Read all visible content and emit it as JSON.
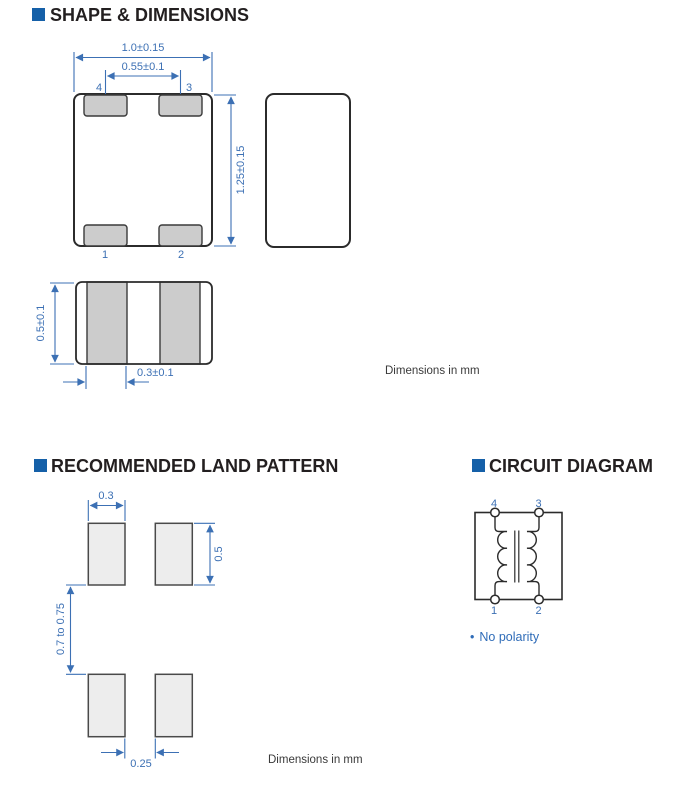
{
  "colors": {
    "accent_blue": "#1560a8",
    "dimension_blue": "#3c70b4",
    "ink": "#231f20",
    "pad_gray": "#cccccc",
    "land_pad_gray": "#ededed"
  },
  "shape_section": {
    "title": "SHAPE & DIMENSIONS",
    "top_view": {
      "dim_width": "1.0±0.15",
      "dim_inner": "0.55±0.1",
      "dim_height": "1.25±0.15",
      "pin_top_left": "4",
      "pin_top_right": "3",
      "pin_bottom_left": "1",
      "pin_bottom_right": "2"
    },
    "bottom_view": {
      "dim_height": "0.5±0.1",
      "dim_terminal": "0.3±0.1"
    },
    "units_note": "Dimensions in mm"
  },
  "land_section": {
    "title": "RECOMMENDED LAND PATTERN",
    "dims": {
      "pad_width": "0.3",
      "pad_height": "0.5",
      "gap_vertical": "0.7 to 0.75",
      "gap_horizontal": "0.25"
    },
    "units_note": "Dimensions in mm"
  },
  "circuit_section": {
    "title": "CIRCUIT DIAGRAM",
    "pins": {
      "top_left": "4",
      "top_right": "3",
      "bottom_left": "1",
      "bottom_right": "2"
    },
    "note_bullet": "•",
    "note": "No polarity"
  }
}
